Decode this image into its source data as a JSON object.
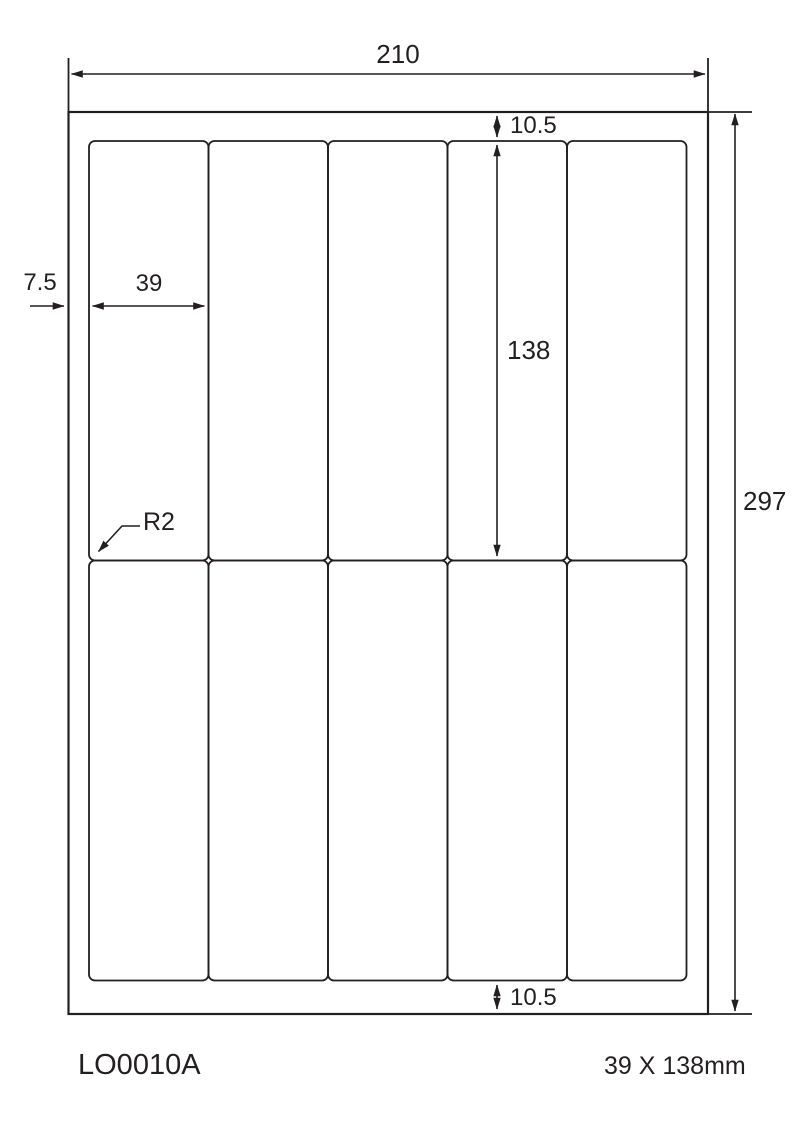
{
  "diagram": {
    "title": "label-sheet-dimension-drawing",
    "sheet": {
      "width_label": "210",
      "height_label": "297"
    },
    "margins": {
      "top_label": "10.5",
      "bottom_label": "10.5",
      "left_label": "7.5"
    },
    "label": {
      "width_label": "39",
      "height_label": "138",
      "corner_radius_label": "R2"
    },
    "grid": {
      "rows": 2,
      "columns": 5,
      "total_labels": 10
    }
  },
  "footer": {
    "product_code": "LO0010A",
    "label_size": "39 X 138mm"
  },
  "colors": {
    "line": "#231f20",
    "background": "#ffffff"
  }
}
